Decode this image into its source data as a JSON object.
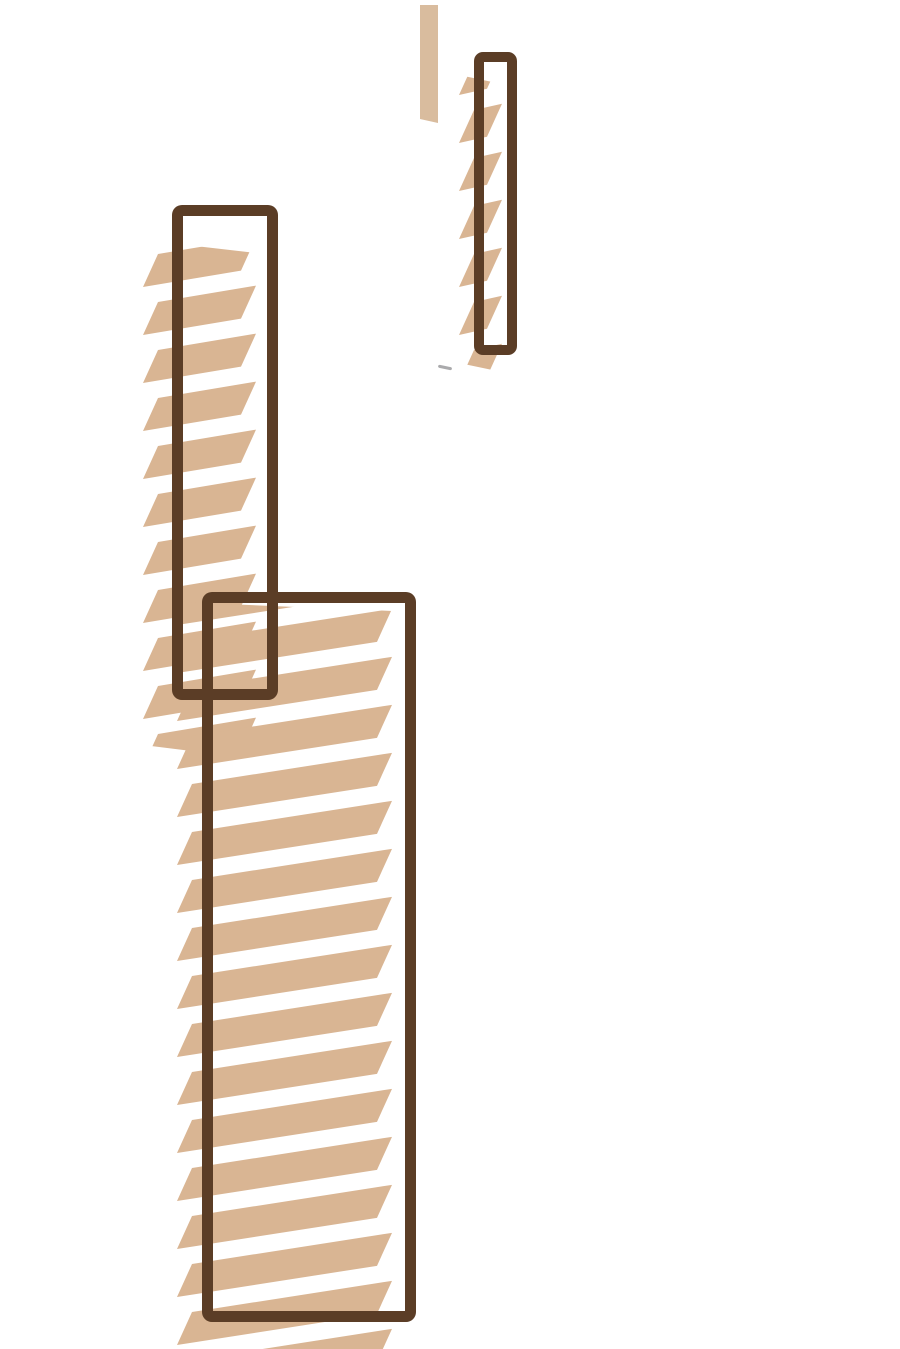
{
  "canvas": {
    "width": 900,
    "height": 1349
  },
  "colors": {
    "background": "#ffffff",
    "tan": "#d9b593",
    "tan_light": "#d9bc9e",
    "brown": "#5b3d26",
    "gray": "#9b9b9d",
    "stripe_gap_white": "#ffffff"
  },
  "hatch_pattern": {
    "period": 48,
    "stroke_thickness": 33,
    "gap": 15,
    "slope": 0.145,
    "chisel": 15
  },
  "shapes": {
    "solid_bar_top": {
      "x": 420,
      "y": 5,
      "w": 18,
      "h": 118,
      "clip": [
        [
          0,
          0
        ],
        [
          18,
          0
        ],
        [
          18,
          118
        ],
        [
          0,
          114
        ]
      ]
    },
    "bar_top_right": {
      "x": 459,
      "y": 74,
      "w": 43,
      "h": 298,
      "phase": 36,
      "clip": [
        [
          0,
          1
        ],
        [
          43,
          10
        ],
        [
          43,
          298
        ],
        [
          0,
          289
        ]
      ]
    },
    "column_mid_left": {
      "x": 143,
      "y": 240,
      "w": 113,
      "h": 519,
      "phase": 14,
      "clip": [
        [
          0,
          0
        ],
        [
          113,
          13
        ],
        [
          113,
          519
        ],
        [
          0,
          505
        ]
      ]
    },
    "column_bottom": {
      "x": 177,
      "y": 602,
      "w": 215,
      "h": 747,
      "phase": 38,
      "clip": [
        [
          0,
          0
        ],
        [
          215,
          9
        ],
        [
          215,
          747
        ],
        [
          0,
          747
        ]
      ]
    },
    "rect_top_right": {
      "x": 474,
      "y": 52,
      "w": 43,
      "h": 303,
      "border": 10,
      "radius": 9
    },
    "rect_mid_left": {
      "x": 172,
      "y": 205,
      "w": 106,
      "h": 495,
      "border": 11,
      "radius": 10
    },
    "rect_bottom": {
      "x": 202,
      "y": 592,
      "w": 214,
      "h": 730,
      "border": 11,
      "radius": 10
    },
    "pen_mark": {
      "x": 438,
      "y": 366,
      "w": 14,
      "h": 3,
      "rotate": 12
    }
  }
}
